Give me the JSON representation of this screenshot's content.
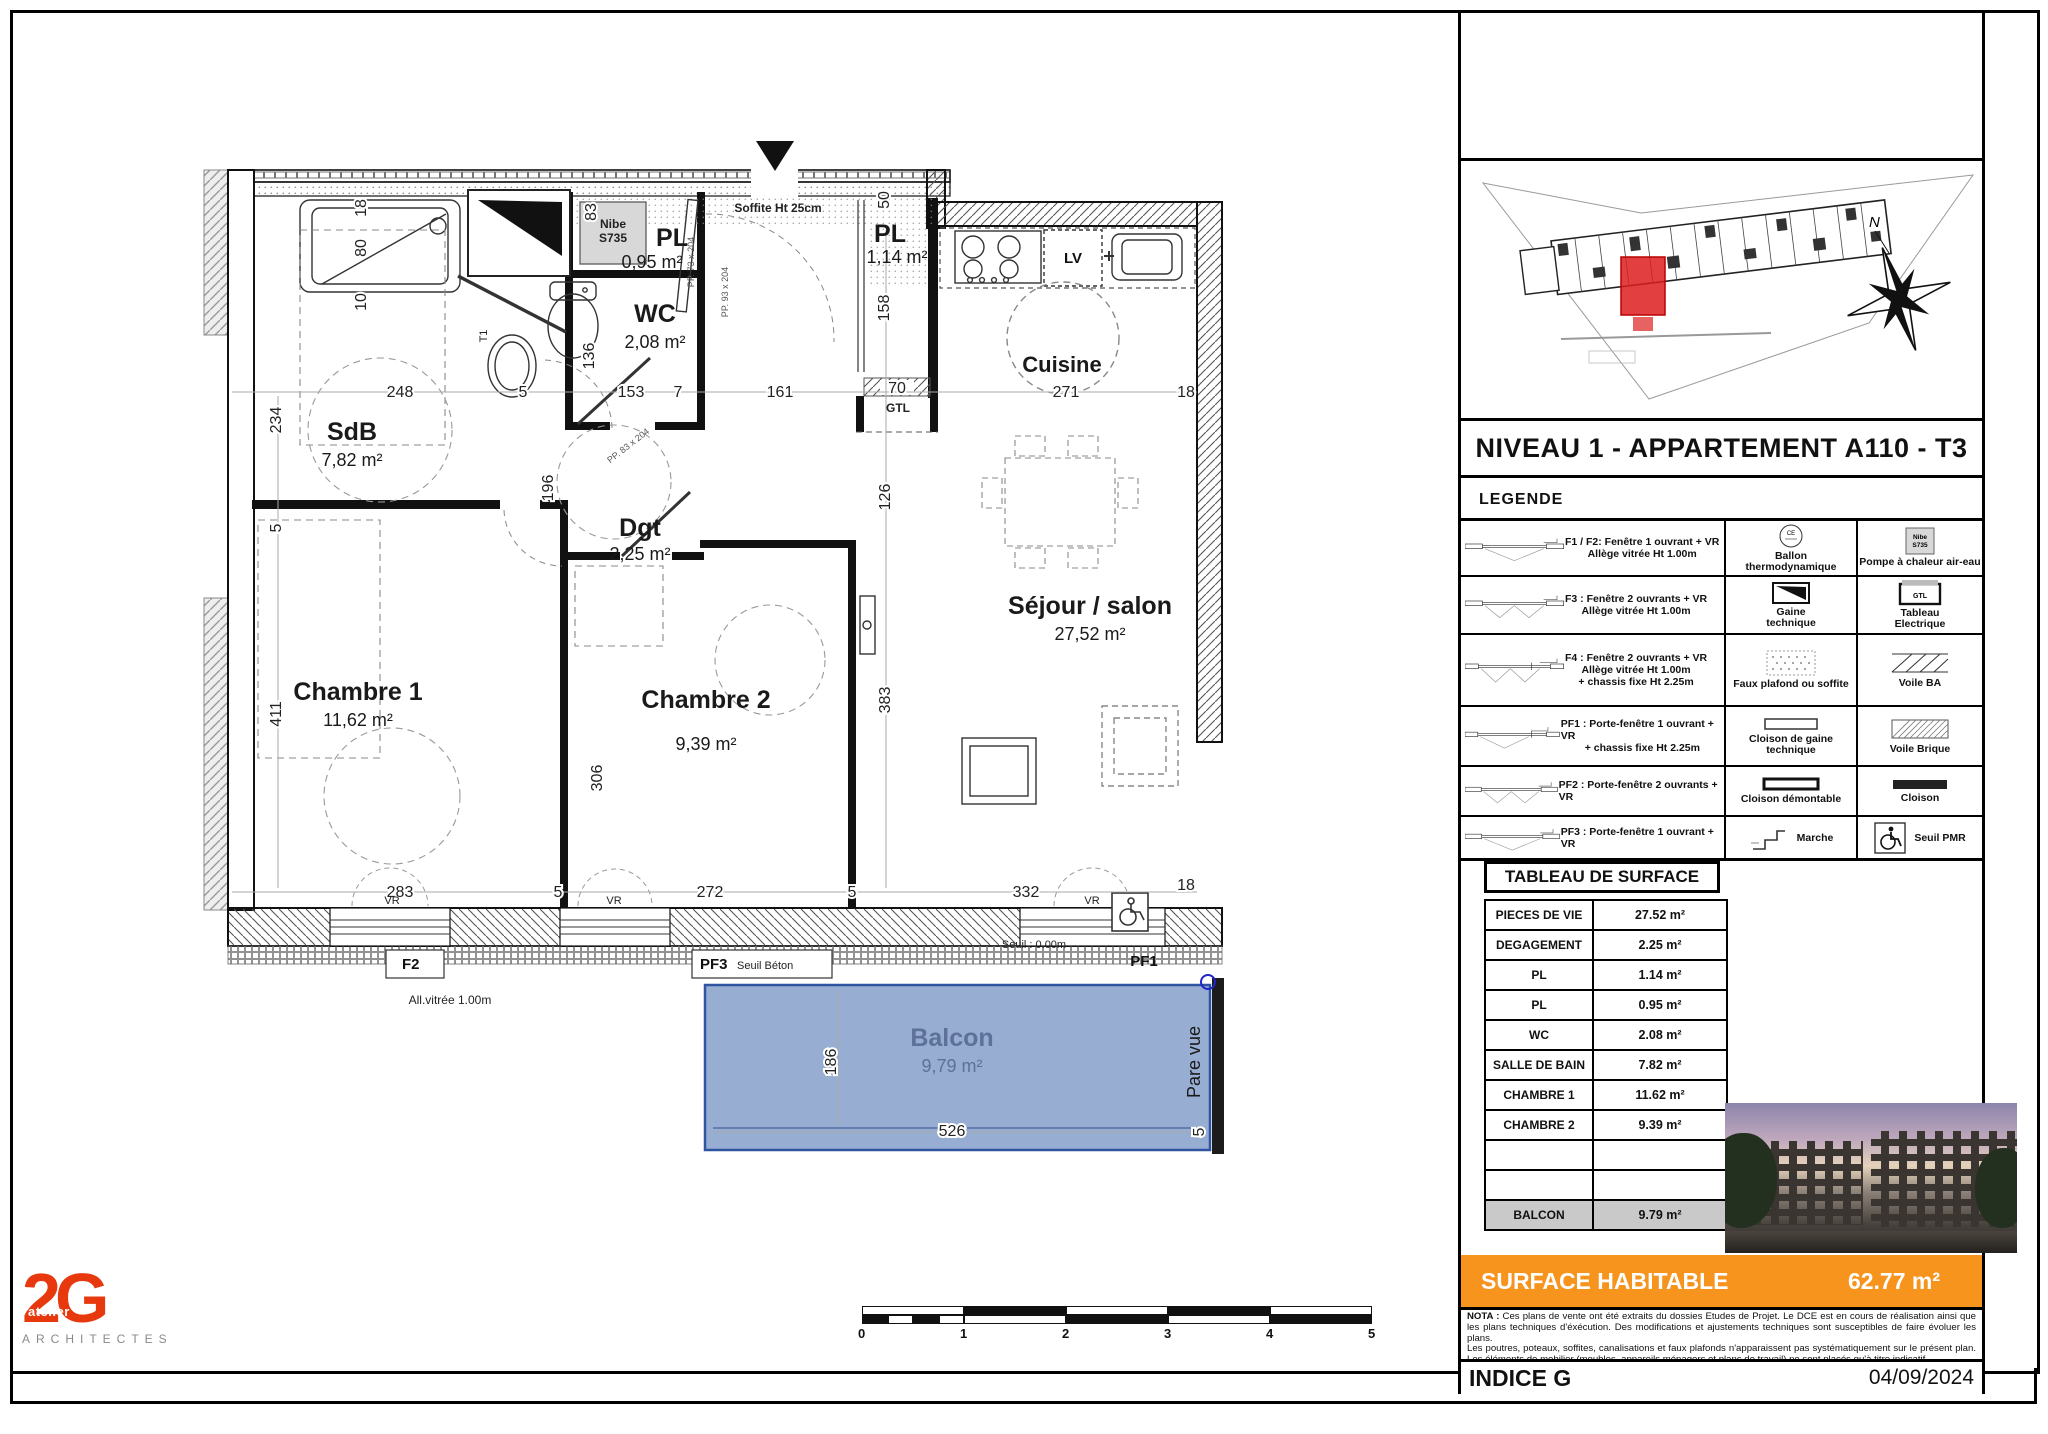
{
  "plan": {
    "rooms": {
      "sdb": {
        "name": "SdB",
        "area": "7,82 m²"
      },
      "wc": {
        "name": "WC",
        "area": "2,08 m²"
      },
      "pl_small": {
        "name": "PL",
        "area": "0,95 m²"
      },
      "pl_entry": {
        "name": "PL",
        "area": "1,14 m²"
      },
      "dgt": {
        "name": "Dgt",
        "area": "2,25 m²"
      },
      "cuisine": {
        "name": "Cuisine"
      },
      "sejour": {
        "name": "Séjour / salon",
        "area": "27,52 m²"
      },
      "chambre1": {
        "name": "Chambre 1",
        "area": "11,62 m²"
      },
      "chambre2": {
        "name": "Chambre 2",
        "area": "9,39 m²"
      },
      "balcon": {
        "name": "Balcon",
        "area": "9,79 m²"
      }
    },
    "dims_top": [
      "248",
      "5",
      "153",
      "7",
      "161",
      "70",
      "271",
      "18"
    ],
    "dims_bottom": [
      "283",
      "5",
      "272",
      "5",
      "332",
      "18"
    ],
    "dims_vert": [
      "18",
      "80",
      "10",
      "83",
      "136",
      "234",
      "5",
      "411",
      "50",
      "158",
      "126",
      "383",
      "306",
      "196"
    ],
    "dims_balcony": [
      "186",
      "526",
      "5"
    ],
    "annotations": {
      "soffite": "Soffite Ht 25cm",
      "nibe1": "Nibe",
      "nibe2": "S735",
      "gtl": "GTL",
      "lv": "LV",
      "t1": "T1",
      "vr": "VR",
      "pare_vue": "Pare vue",
      "f2": "F2",
      "all_vitree": "All.vitrée 1.00m",
      "pf3": "PF3",
      "seuil_beton": "Seuil Béton",
      "pf1": "PF1",
      "seuil_zero": "Seuil : 0.00m",
      "pp73": "PP. 73 x 204",
      "pp93": "PP. 93 x 204",
      "pp83": "PP. 83 x 204"
    }
  },
  "panel": {
    "title": "NIVEAU 1 - APPARTEMENT A110 - T3",
    "north": "N",
    "legende_title": "LEGENDE",
    "legend_left": [
      {
        "l1": "F1 / F2: Fenêtre 1 ouvrant + VR",
        "l2": "Allège vitrée Ht 1.00m"
      },
      {
        "l1": "F3 : Fenêtre 2 ouvrants + VR",
        "l2": "Allège vitrée Ht 1.00m"
      },
      {
        "l1": "F4 : Fenêtre 2 ouvrants + VR",
        "l2": "Allège vitrée Ht 1.00m",
        "l3": "+ chassis fixe Ht 2.25m"
      },
      {
        "l1": "PF1 : Porte-fenêtre 1 ouvrant + VR",
        "l2": "+ chassis fixe Ht 2.25m"
      },
      {
        "l1": "PF2 : Porte-fenêtre 2 ouvrants + VR"
      },
      {
        "l1": "PF3 : Porte-fenêtre 1 ouvrant + VR"
      }
    ],
    "legend_mid": [
      {
        "l1": "Ballon",
        "l2": "thermodynamique"
      },
      {
        "l1": "Gaine",
        "l2": "technique"
      },
      {
        "l1": "Faux plafond ou soffite"
      },
      {
        "l1": "Cloison de gaine",
        "l2": "technique"
      },
      {
        "l1": "Cloison démontable"
      },
      {
        "l1": "Marche"
      }
    ],
    "legend_right": [
      {
        "l1": "Pompe à chaleur air-eau"
      },
      {
        "l1": "Tableau",
        "l2": "Electrique"
      },
      {
        "l1": "Voile BA"
      },
      {
        "l1": "Voile Brique"
      },
      {
        "l1": "Cloison"
      },
      {
        "l1": "Seuil PMR"
      }
    ],
    "icon_text": {
      "ce": "CE",
      "nibe1": "Nibe",
      "nibe2": "S735",
      "gtl": "GTL"
    },
    "table": {
      "header": "TABLEAU DE SURFACE",
      "rows": [
        {
          "label": "PIECES DE VIE",
          "value": "27.52 m²"
        },
        {
          "label": "DEGAGEMENT",
          "value": "2.25 m²"
        },
        {
          "label": "PL",
          "value": "1.14 m²"
        },
        {
          "label": "PL",
          "value": "0.95 m²"
        },
        {
          "label": "WC",
          "value": "2.08 m²"
        },
        {
          "label": "SALLE DE BAIN",
          "value": "7.82 m²"
        },
        {
          "label": "CHAMBRE 1",
          "value": "11.62 m²"
        },
        {
          "label": "CHAMBRE 2",
          "value": "9.39 m²"
        },
        {
          "label": "",
          "value": ""
        },
        {
          "label": "",
          "value": ""
        },
        {
          "label": "BALCON",
          "value": "9.79 m²"
        }
      ]
    },
    "surface": {
      "label": "SURFACE HABITABLE",
      "value": "62.77 m²"
    },
    "nota": {
      "bold": "NOTA :",
      "text1": " Ces plans de vente ont été extraits du dossies Etudes de Projet. Le DCE est en cours de réalisation ainsi que les plans techniques d'éxécution. Des modifications et ajustements techniques sont susceptibles de faire évoluer les plans.",
      "text2": "Les poutres, poteaux, soffites, canalisations et faux plafonds n'apparaissent pas systématiquement sur le présent plan. Les éléments de mobilier (meubles, appareils ménagers et plans de travail) ne sont placés qu'à titre indicatif."
    },
    "indice": "INDICE G",
    "date": "04/09/2024"
  },
  "logo": {
    "letter1": "2",
    "letter2": "G",
    "atelier": "atelier",
    "architectes": "ARCHITECTES"
  },
  "scalebar": {
    "labels": [
      "0",
      "1",
      "2",
      "3",
      "4",
      "5"
    ]
  },
  "colors": {
    "accent_orange": "#F7941D",
    "logo_red": "#E8380D",
    "balcony_fill": "#8EA6CE",
    "balcony_border": "#2F55A0",
    "site_highlight_red": "#DD1F1F"
  }
}
